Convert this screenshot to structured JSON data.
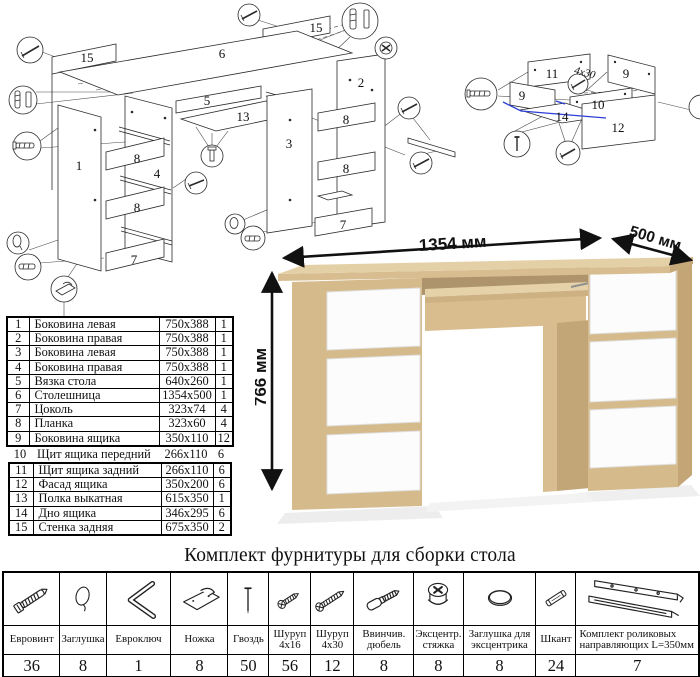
{
  "title": "Комплект фурнитуры для сборки стола",
  "dimensions": {
    "width": "1354 мм",
    "depth": "500 мм",
    "height": "766 мм"
  },
  "parts_table": {
    "rows": [
      {
        "num": "1",
        "name": "Боковина левая",
        "size": "750x388",
        "qty": "1"
      },
      {
        "num": "2",
        "name": "Боковина правая",
        "size": "750x388",
        "qty": "1"
      },
      {
        "num": "3",
        "name": "Боковина левая",
        "size": "750x388",
        "qty": "1"
      },
      {
        "num": "4",
        "name": "Боковина правая",
        "size": "750x388",
        "qty": "1"
      },
      {
        "num": "5",
        "name": "Вязка стола",
        "size": "640x260",
        "qty": "1"
      },
      {
        "num": "6",
        "name": "Столешница",
        "size": "1354x500",
        "qty": "1"
      },
      {
        "num": "7",
        "name": "Цоколь",
        "size": "323x74",
        "qty": "4"
      },
      {
        "num": "8",
        "name": "Планка",
        "size": "323x60",
        "qty": "4"
      },
      {
        "num": "9",
        "name": "Боковина ящика",
        "size": "350x110",
        "qty": "12"
      },
      {
        "num": "10",
        "name": "Щит ящика передний",
        "size": "266x110",
        "qty": "6"
      },
      {
        "num": "11",
        "name": "Щит ящика задний",
        "size": "266x110",
        "qty": "6"
      },
      {
        "num": "12",
        "name": "Фасад ящика",
        "size": "350x200",
        "qty": "6"
      },
      {
        "num": "13",
        "name": "Полка выкатная",
        "size": "615x350",
        "qty": "1"
      },
      {
        "num": "14",
        "name": "Дно ящика",
        "size": "346x295",
        "qty": "6"
      },
      {
        "num": "15",
        "name": "Стенка задняя",
        "size": "675x350",
        "qty": "2"
      }
    ]
  },
  "hardware": {
    "items": [
      {
        "name": "Евровинт",
        "qty": "36",
        "icon": "confirmat-screw"
      },
      {
        "name": "Заглушка",
        "qty": "8",
        "icon": "cap"
      },
      {
        "name": "Евроключ",
        "qty": "1",
        "icon": "hex-key"
      },
      {
        "name": "Ножка",
        "qty": "8",
        "icon": "foot-glide"
      },
      {
        "name": "Гвоздь",
        "qty": "50",
        "icon": "nail"
      },
      {
        "name": "Шуруп 4x16",
        "qty": "56",
        "icon": "screw-4x16"
      },
      {
        "name": "Шуруп 4x30",
        "qty": "12",
        "icon": "screw-4x30"
      },
      {
        "name": "Ввинчив. дюбель",
        "qty": "8",
        "icon": "screw-in-dowel"
      },
      {
        "name": "Эксцентр. стяжка",
        "qty": "8",
        "icon": "cam-lock"
      },
      {
        "name": "Заглушка для эксцентрика",
        "qty": "8",
        "icon": "cam-cap"
      },
      {
        "name": "Шкант",
        "qty": "24",
        "icon": "wood-dowel"
      },
      {
        "name": "Комплект роликовых направляющих L=350мм",
        "qty": "7",
        "icon": "drawer-slides"
      }
    ]
  },
  "assembly_diagram": {
    "part_labels": {
      "p15_left": "15",
      "p6": "6",
      "p15_right": "15",
      "p5": "5",
      "p13": "13",
      "p1": "1",
      "p4": "4",
      "p8_l1": "8",
      "p8_l2": "8",
      "p7_l": "7",
      "p3": "3",
      "p2": "2",
      "p8_r1": "8",
      "p8_r2": "8",
      "p7_r": "7"
    }
  },
  "drawer_diagram": {
    "part_labels": {
      "p11": "11",
      "p9_left": "9",
      "p9_right": "9",
      "p10": "10",
      "p14": "14",
      "p12": "12"
    },
    "screw_note": "4x30"
  },
  "colors": {
    "highlight_blue": "#2b3fd8",
    "oak_top": "#e4d0a6",
    "oak_front": "#d5ba8c",
    "oak_side": "#c4a676",
    "drawer_white": "#fcfcfc"
  }
}
